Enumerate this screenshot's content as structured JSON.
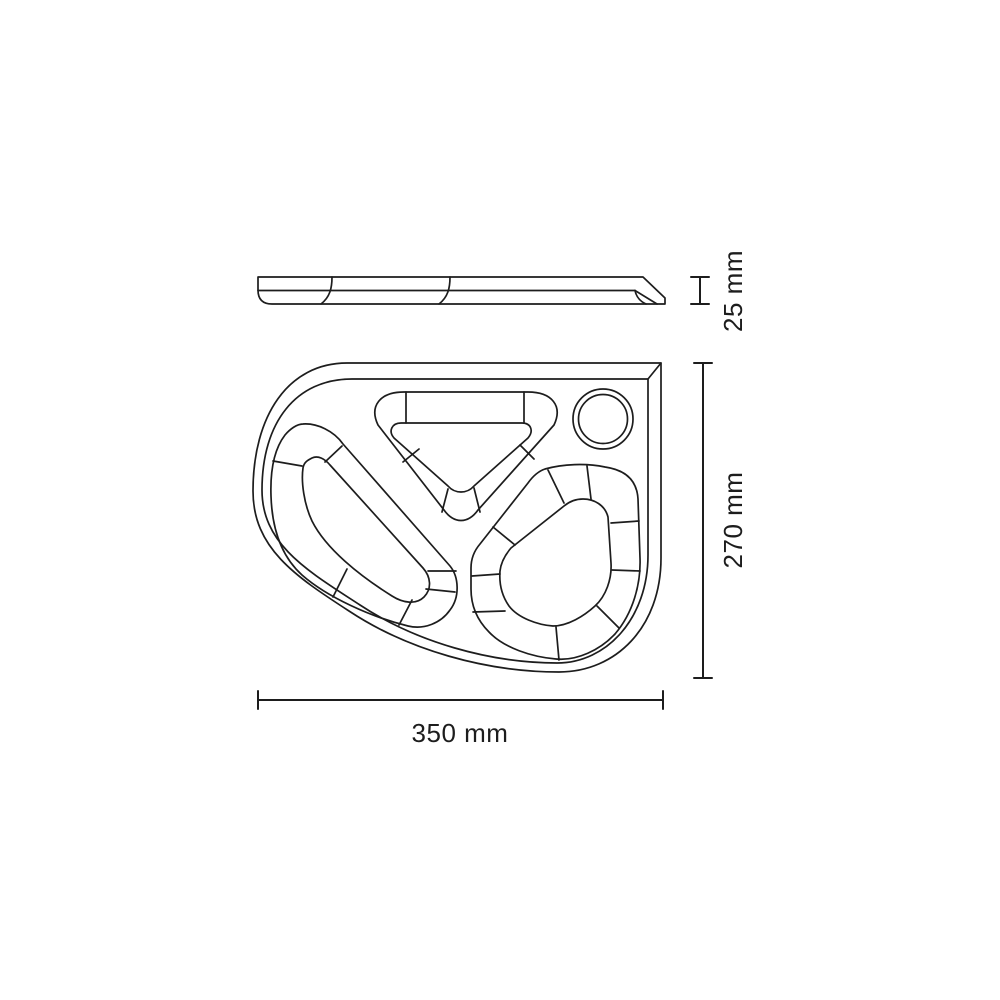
{
  "colors": {
    "line": "#1d1d1d",
    "background": "#ffffff"
  },
  "labels": {
    "thickness": "25 mm",
    "height": "270 mm",
    "width": "350 mm"
  }
}
